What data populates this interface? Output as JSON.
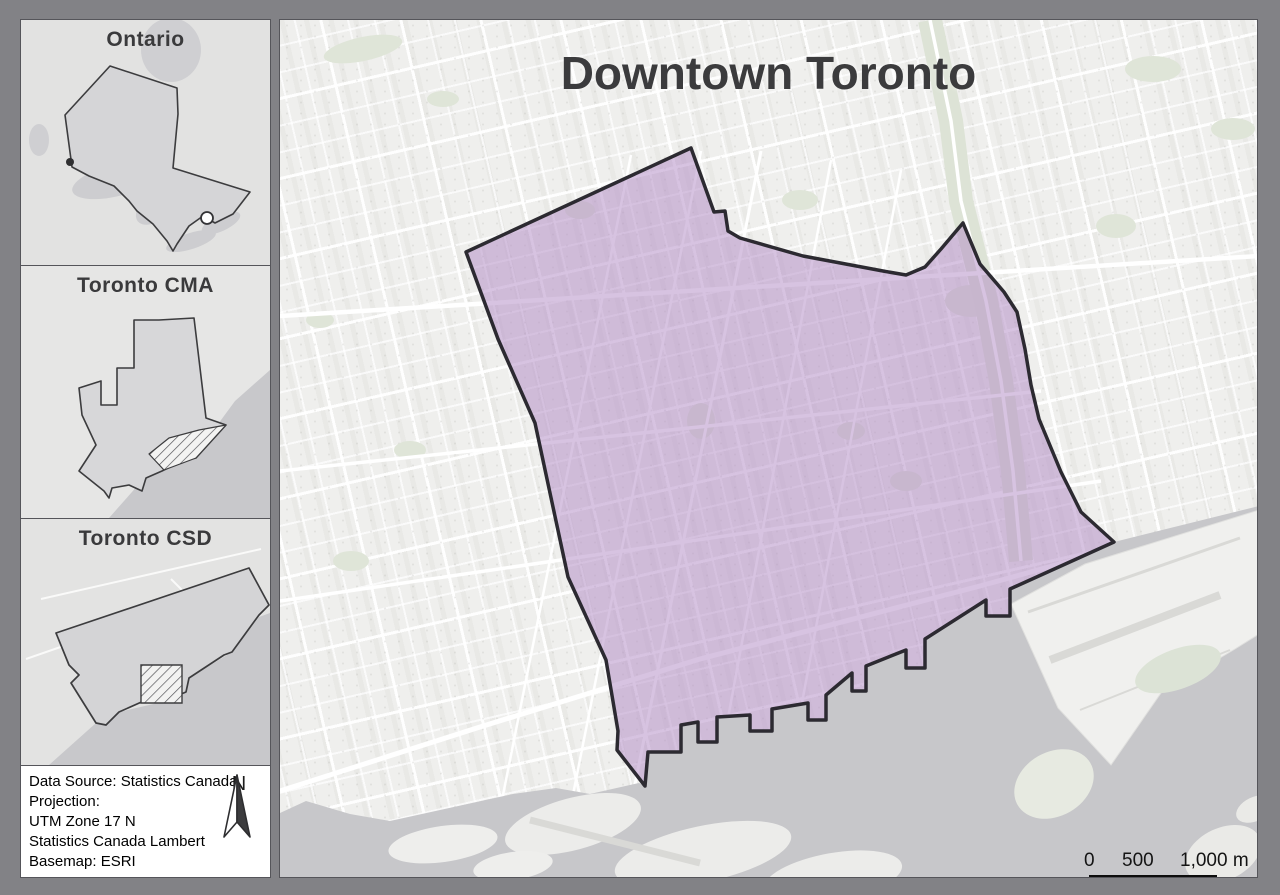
{
  "main_map": {
    "title": "Downtown Toronto",
    "region_highlighted": "Downtown Toronto boundary polygon",
    "scale_bar": {
      "tick_labels": [
        "0",
        "500",
        "1,000 m"
      ]
    },
    "colors": {
      "land": "#efefed",
      "water": "#c7c7ca",
      "islands": "#ececea",
      "parks": "#dfe5d8",
      "highlight_fill": "#c9afd3",
      "highlight_outline": "#2c2a31",
      "frame": "#828286"
    }
  },
  "insets": {
    "ontario": {
      "title": "Ontario"
    },
    "cma": {
      "title": "Toronto CMA"
    },
    "csd": {
      "title": "Toronto CSD"
    }
  },
  "info_box": {
    "lines": [
      "Data Source: Statistics Canada",
      "Projection:",
      "UTM Zone 17 N",
      "Statistics Canada Lambert",
      "Basemap: ESRI"
    ],
    "north_arrow_label": "N"
  }
}
